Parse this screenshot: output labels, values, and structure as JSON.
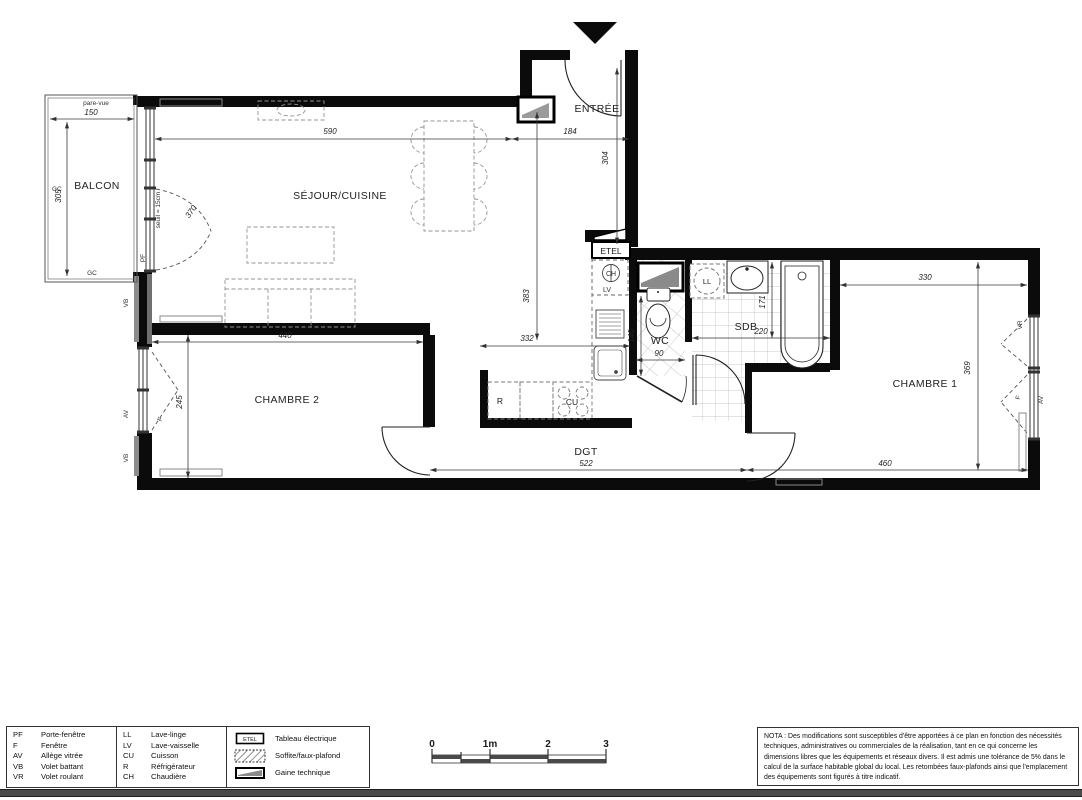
{
  "rooms": {
    "balcon": "BALCON",
    "sejour": "SÉJOUR/CUISINE",
    "entree": "ENTRÉE",
    "chambre1": "CHAMBRE 1",
    "chambre2": "CHAMBRE 2",
    "sdb": "SDB",
    "wc": "WC",
    "dgt": "DGT"
  },
  "dims": {
    "balcon_w": "150",
    "balcon_h": "305",
    "sejour_w": "590",
    "sejour_h": "383",
    "entree_w": "184",
    "entree_h": "304",
    "pf_w": "370",
    "cuisine_w": "332",
    "chambre2_w": "440",
    "chambre2_h": "245",
    "wc_h": "140",
    "wc_w": "90",
    "sdb_w": "220",
    "sdb_h": "171",
    "chambre1_w_top": "330",
    "chambre1_h": "369",
    "chambre1_w_bot": "460",
    "dgt_w": "522"
  },
  "wall": {
    "pare_vue": "pare-vue",
    "gc": "GC",
    "vb": "VB",
    "av": "AV",
    "pf": "PF",
    "f": "F",
    "vr": "VR",
    "seuil": "seuil = 15cm"
  },
  "equip": {
    "etel": "ETEL",
    "ch": "CH",
    "lv": "LV",
    "ll": "LL",
    "r": "R",
    "cu": "CU"
  },
  "legend": {
    "col1": [
      {
        "abbr": "PF",
        "label": "Porte-fenêtre"
      },
      {
        "abbr": "F",
        "label": "Fenêtre"
      },
      {
        "abbr": "AV",
        "label": "Allège vitrée"
      },
      {
        "abbr": "VB",
        "label": "Volet battant"
      },
      {
        "abbr": "VR",
        "label": "Volet roulant"
      }
    ],
    "col2": [
      {
        "abbr": "LL",
        "label": "Lave-linge"
      },
      {
        "abbr": "LV",
        "label": "Lave-vaisselle"
      },
      {
        "abbr": "CU",
        "label": "Cuisson"
      },
      {
        "abbr": "R",
        "label": "Réfrigérateur"
      },
      {
        "abbr": "CH",
        "label": "Chaudière"
      }
    ],
    "symbols": [
      {
        "label": "Tableau électrique"
      },
      {
        "label": "Soffite/faux-plafond"
      },
      {
        "label": "Gaine technique"
      }
    ],
    "etel": "ETEL"
  },
  "scale": {
    "t0": "0",
    "t1": "1m",
    "t2": "2",
    "t3": "3"
  },
  "nota": {
    "text": "NOTA : Des modifications sont susceptibles d'être apportées à ce plan en fonction des nécessités techniques, administratives ou commerciales de la réalisation, tant en ce qui concerne les dimensions libres que les équipements et réseaux divers. Il est admis une tolérance de 5% dans le calcul de la surface habitable global du local. Les retombées faux-plafonds ainsi que l'emplacement des équipements sont figurés à titre indicatif."
  }
}
